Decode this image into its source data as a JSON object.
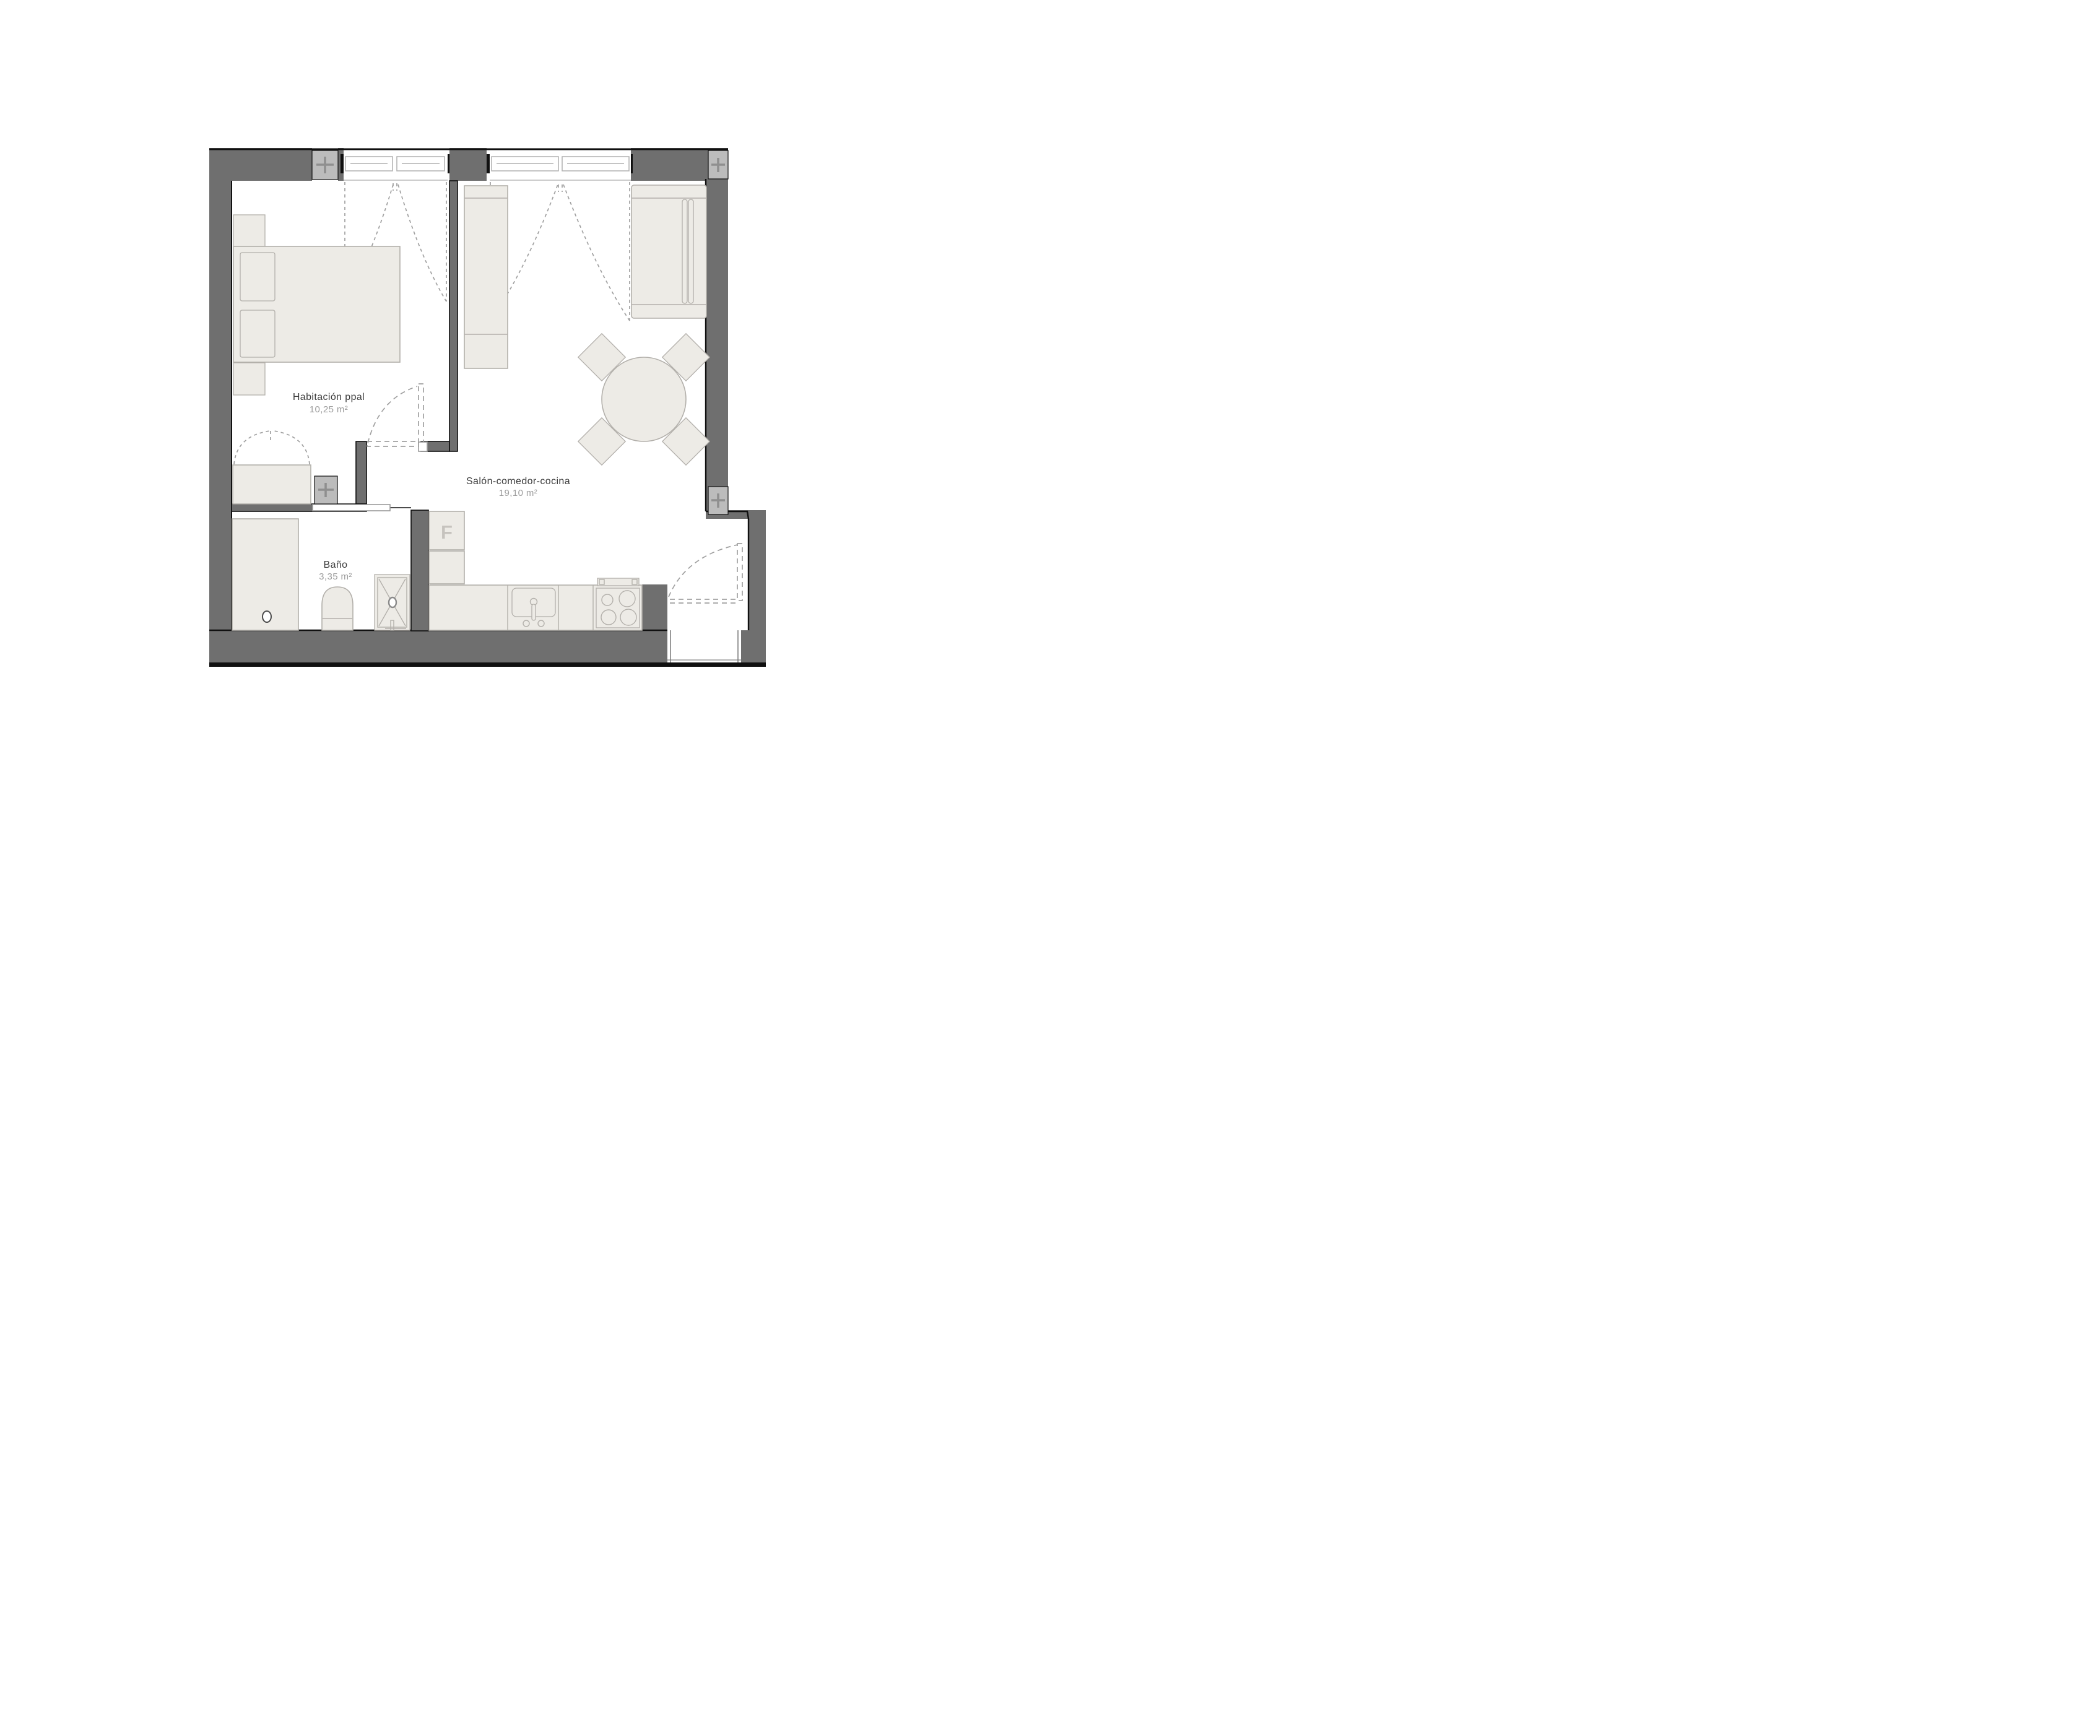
{
  "rooms": [
    {
      "name": "Habitación ppal",
      "area": "10,25 m²"
    },
    {
      "name": "Salón-comedor-cocina",
      "area": "19,10 m²"
    },
    {
      "name": "Baño",
      "area": "3,35 m²"
    }
  ],
  "fridge_label": "F",
  "colors": {
    "wall": "#6f6f6f",
    "ink": "#101010",
    "col": "#bcbcbc",
    "plus": "#8f8f8f",
    "furn": "#edebe6",
    "furnline": "#b3b0ab",
    "dash": "#a0a0a0",
    "frame": "#b1b1b1",
    "sill": "#cccccc",
    "label": "#3c3c3c",
    "muted": "#9c9c9c",
    "bg": "#ffffff"
  }
}
